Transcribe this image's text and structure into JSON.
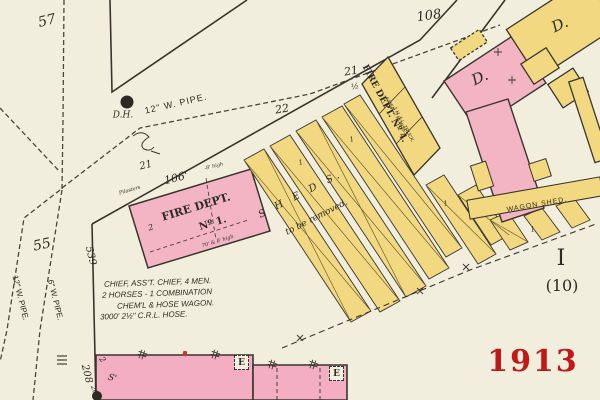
{
  "year": "1913",
  "block": {
    "roman": "I",
    "number": "(10)"
  },
  "street_numbers": {
    "n57": "57",
    "n108": "108",
    "n55": "55",
    "n539": "539",
    "n208": "208",
    "n22": "22",
    "n21_fd1": "21",
    "n21_sheds": "21",
    "n21_half": "½",
    "n2": "2",
    "n26": "26'",
    "s_mark": "S'"
  },
  "pipes": {
    "main": "12\" W. PIPE.",
    "west_12": "12\" W. PIPE.",
    "west_6": "6\" W. PIPE.",
    "hydrant": "D.H."
  },
  "fire_dept_1": {
    "name_line1": "FIRE DEPT.",
    "name_line2": "Nº 1.",
    "frontage": "106'",
    "frontage_note": "-8' high",
    "edge_note": "Pilasters",
    "size_note": "70' & 8' high",
    "stories": "2",
    "crew_line1": "CHIEF, ASS'T. CHIEF, 4 MEN.",
    "crew_line2": "2 HORSES - 1 COMBINATION",
    "crew_line3": "CHEM'L & HOSE WAGON.",
    "crew_line4": "3000' 2½\" C.R.L. HOSE."
  },
  "fire_dept_4": {
    "name": "FIRE DEPT. Nº 4.",
    "crew_line1": "4 MEN. 2 HORSES.",
    "crew_line2": "1 H. & L. TRUCK."
  },
  "sheds": {
    "label": "S H E D S.",
    "note": "to be removed.",
    "story_mark": "1"
  },
  "wagon_shed": {
    "label": "WAGON SHED."
  },
  "dwellings": {
    "pink": "D.",
    "yellow": "D."
  },
  "shutters": {
    "e1": "E",
    "e2": "E"
  },
  "colors": {
    "pink": "#f3b4c4",
    "yellow": "#f2d981",
    "ink": "#3a352c",
    "red": "#c41717"
  }
}
